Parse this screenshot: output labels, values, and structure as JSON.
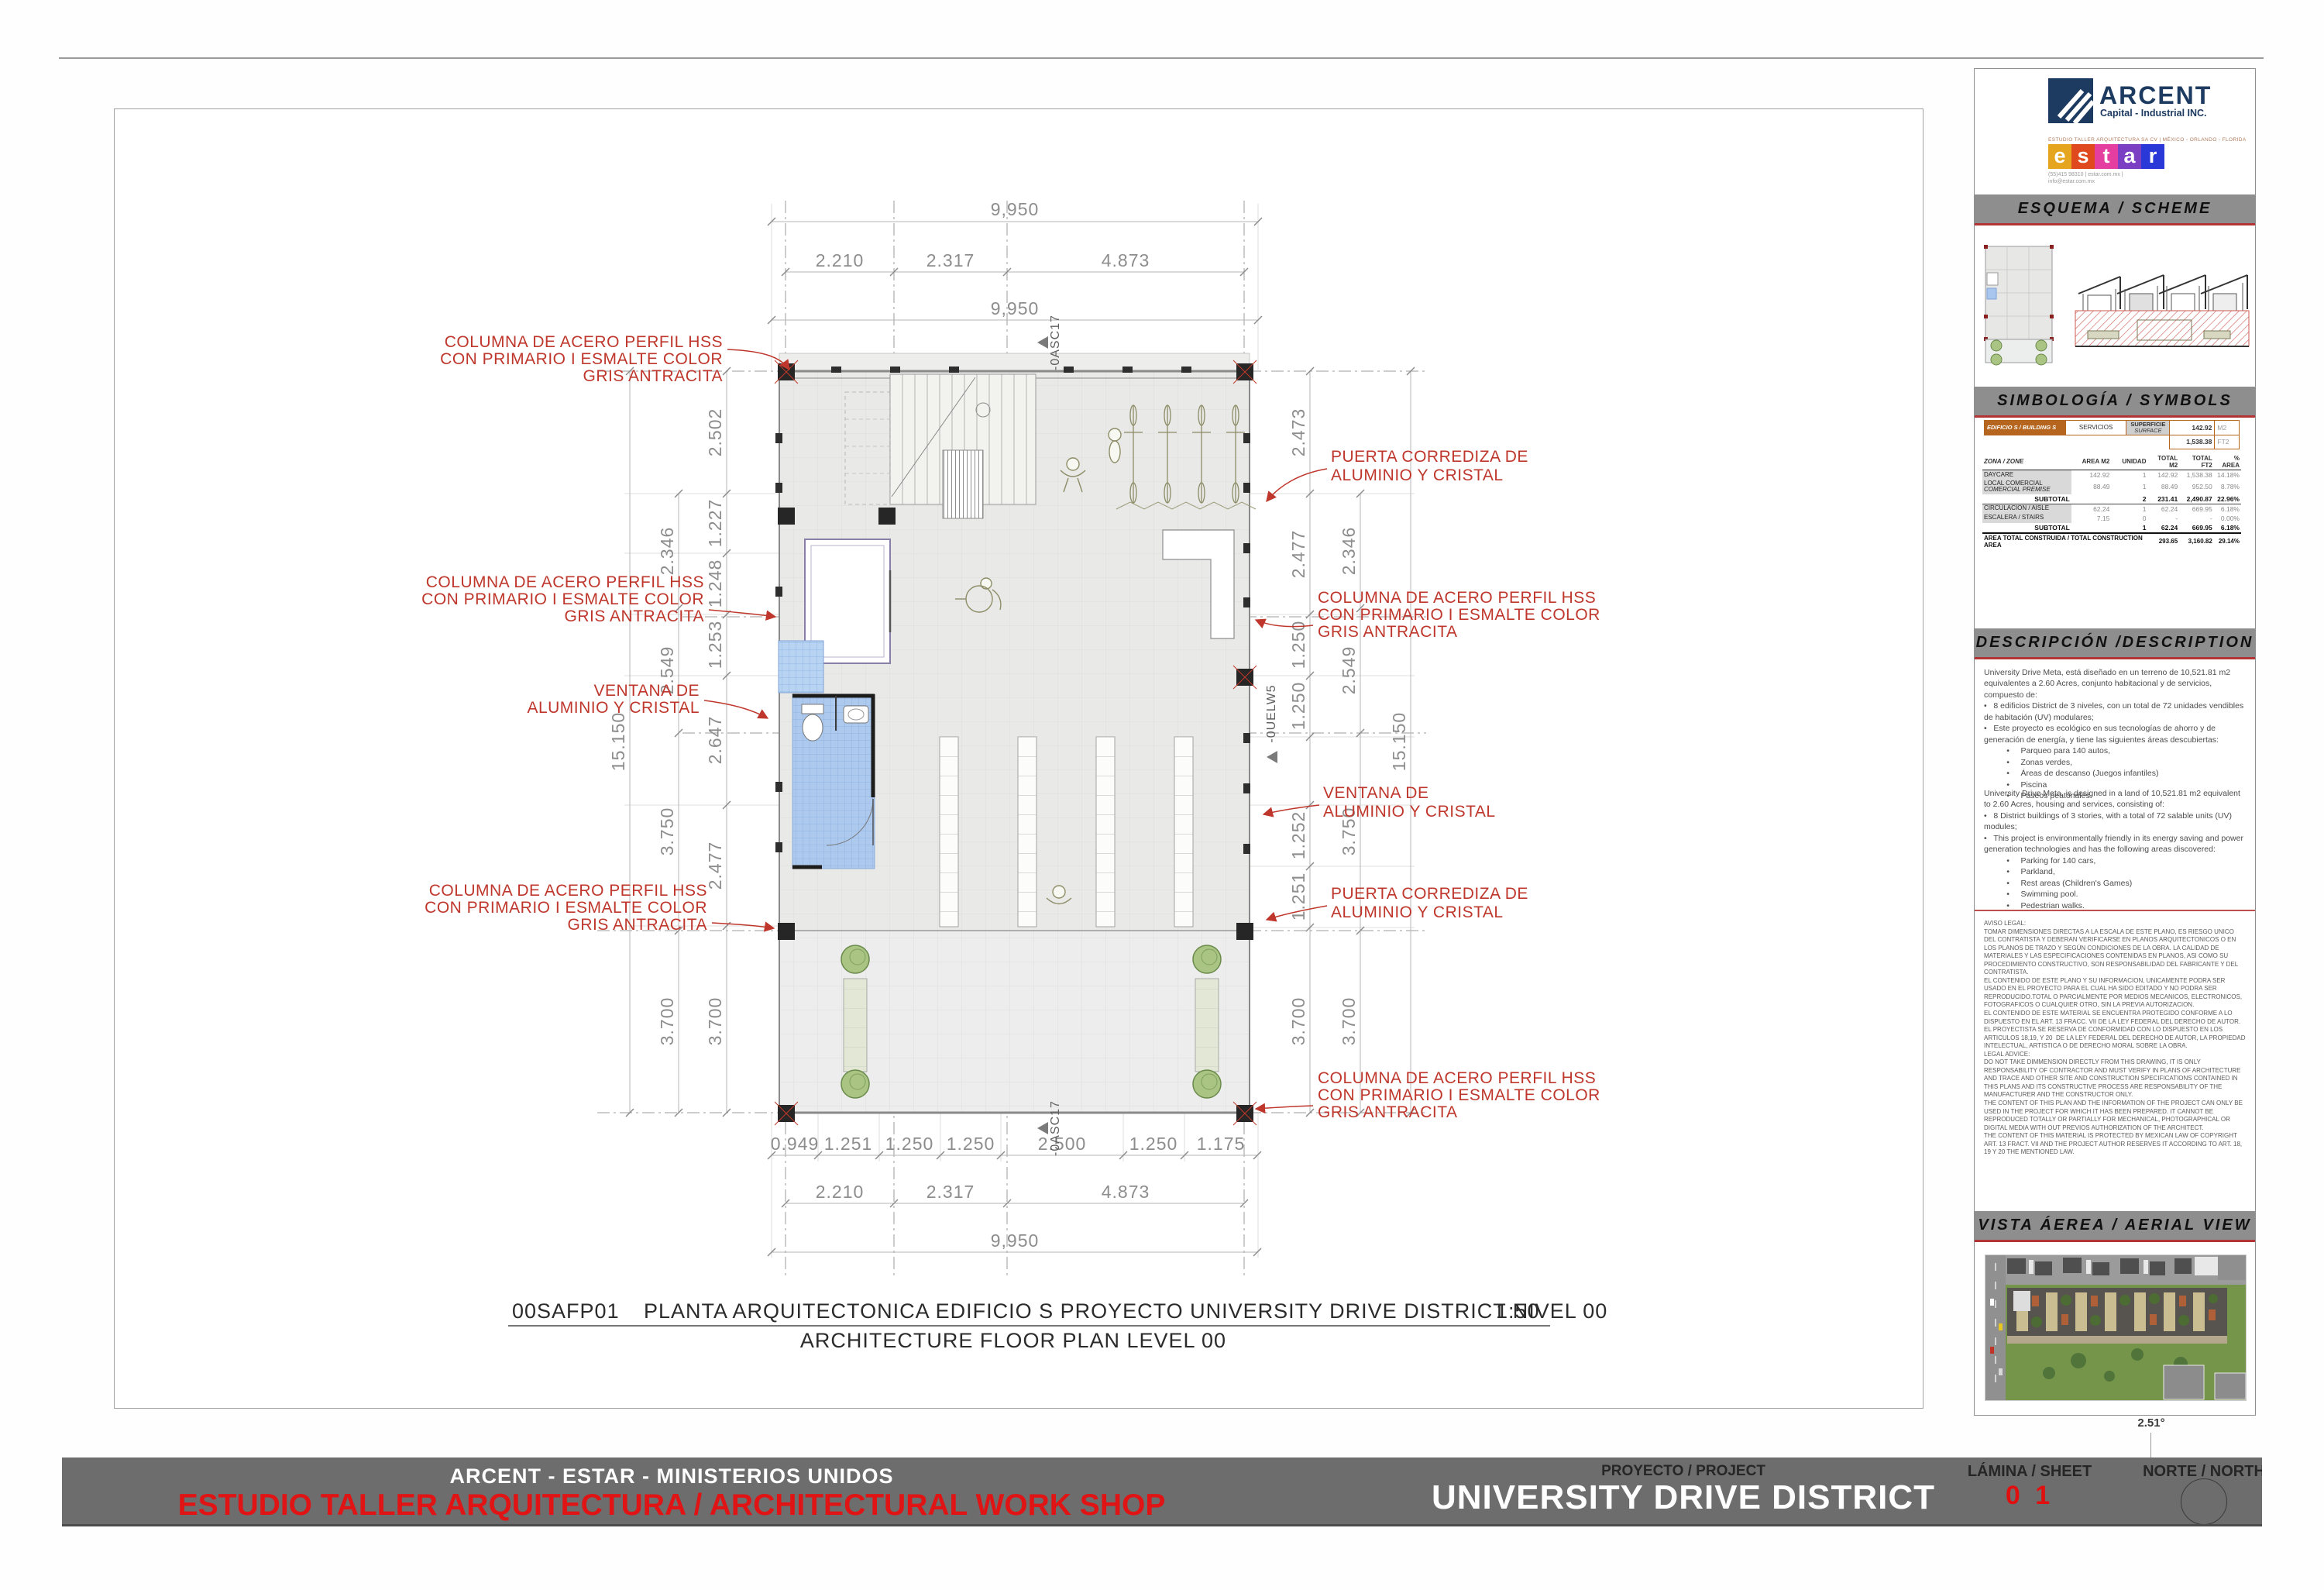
{
  "plan": {
    "title": {
      "code": "00SAFP01",
      "text": "PLANTA ARQUITECTONICA EDIFICIO S  PROYECTO UNIVERSITY DRIVE DISTRICT NIVEL 00",
      "scale": "1:50",
      "subtitle": "ARCHITECTURE FLOOR PLAN LEVEL 00"
    },
    "dims": {
      "total_w": "9,950",
      "total_h": "15.150",
      "top": [
        "2.210",
        "2.317",
        "4.873"
      ],
      "bottom": [
        "0.949",
        "1.251",
        "1.250",
        "1.250",
        "2.500",
        "1.250",
        "1.175"
      ],
      "left_inner": [
        "2.502",
        "1.227",
        "1.248",
        "1.253",
        "2.647",
        "2.477",
        "3.700"
      ],
      "left_mid": [
        "2.346",
        "2.549",
        "3.750",
        "3.700"
      ],
      "right_inner": [
        "2.473",
        "2.477",
        "1.250",
        "1.250",
        "1.252",
        "1.251",
        "3.700"
      ],
      "right_mid": [
        "2.346",
        "2.549",
        "3.750",
        "3.700"
      ]
    },
    "markers": {
      "top": "-0ASC17",
      "bottom": "-0ASC17",
      "right": "-0UELW5"
    },
    "annotations": {
      "columna": [
        "COLUMNA DE ACERO PERFIL HSS",
        "CON PRIMARIO I ESMALTE COLOR",
        "GRIS ANTRACITA"
      ],
      "ventana": [
        "VENTANA DE",
        "ALUMINIO Y CRISTAL"
      ],
      "puerta": [
        "PUERTA CORREDIZA DE",
        "ALUMINIO Y CRISTAL"
      ]
    }
  },
  "panel": {
    "arcent": {
      "name": "ARCENT",
      "tagline": "Capital - Industrial INC."
    },
    "estar": {
      "top": "ESTUDIO TALLER ARQUITECTURA SA CV | MÉXICO - ORLANDO - FLORIDA",
      "letters": [
        "e",
        "s",
        "t",
        "a",
        "r"
      ],
      "colors": [
        "#e6a51e",
        "#e0491d",
        "#e43fa0",
        "#7b3fc4",
        "#2b38d8"
      ],
      "contact": "(55)415 98310   |   estar.com.mx   |\ninfo@estar.com.mx"
    },
    "sections": {
      "esquema": "ESQUEMA / SCHEME",
      "simbologia": "SIMBOLOGÍA / SYMBOLS",
      "descripcion": "DESCRIPCIÓN /DESCRIPTION",
      "vista": "VISTA ÁEREA / AERIAL VIEW"
    },
    "table": {
      "building_label": "EDIFICIO S / BUILDING S",
      "building_use": "SERVICIOS",
      "surface_label_es": "SUPERFICIE",
      "surface_label_en": "SURFACE",
      "surface_m2": "142.92",
      "unit_m2": "M2",
      "surface_ft2": "1,538.38",
      "unit_ft2": "FT2",
      "headers": {
        "zone": "ZONA / ZONE",
        "area": "AREA M2",
        "unit": "UNIDAD",
        "tm2": "TOTAL M2",
        "tft2": "TOTAL FT2",
        "pct": "% AREA"
      },
      "rows": [
        {
          "zone": "DAYCARE",
          "zone2": "",
          "area": "142.92",
          "unit": "1",
          "m2": "142.92",
          "ft2": "1,538.38",
          "pct": "14.18%"
        },
        {
          "zone": "LOCAL COMERCIAL",
          "zone2": "COMERCIAL PREMISE",
          "area": "88.49",
          "unit": "1",
          "m2": "88.49",
          "ft2": "952.50",
          "pct": "8.78%"
        },
        {
          "zone": "SUBTOTAL",
          "zone2": "",
          "area": "",
          "unit": "2",
          "m2": "231.41",
          "ft2": "2,490.87",
          "pct": "22.96%"
        },
        {
          "zone": "CIRCULACION  / AISLE",
          "zone2": "",
          "area": "62.24",
          "unit": "1",
          "m2": "62.24",
          "ft2": "669.95",
          "pct": "6.18%"
        },
        {
          "zone": "ESCALERA / STAIRS",
          "zone2": "",
          "area": "7.15",
          "unit": "0",
          "m2": "-",
          "ft2": "-",
          "pct": "0.00%"
        },
        {
          "zone": "SUBTOTAL",
          "zone2": "",
          "area": "",
          "unit": "1",
          "m2": "62.24",
          "ft2": "669.95",
          "pct": "6.18%"
        }
      ],
      "total": {
        "label": "AREA TOTAL CONSTRUIDA  / TOTAL CONSTRUCTION AREA",
        "m2": "293.65",
        "ft2": "3,160.82",
        "pct": "29.14%"
      }
    },
    "description": {
      "es": "University Drive Meta, está diseñado en un terreno de 10,521.81 m2 equivalentes a 2.60 Acres, conjunto habitacional y de servicios, compuesto de:\n•   8 edificios District de 3 niveles, con un total de 72 unidades vendibles de habitación (UV) modulares;\n•   Este proyecto es ecológico en sus tecnologías de ahorro y de generación de energía, y tiene las siguientes áreas descubiertas:\n          •     Parqueo para 140 autos,\n          •     Zonas verdes,\n          •     Áreas de descanso (Juegos infantiles)\n          •     Piscina\n          •     Paseos peatonales.",
      "en": "University Drive Meta, is designed in a land of 10,521.81 m2 equivalent to 2.60 Acres, housing and services, consisting of:\n•   8 District buildings of 3 stories, with a total of 72 salable units (UV) modules;\n•   This project is environmentally friendly in its energy saving and power generation technologies and has the following areas discovered:\n          •     Parking for 140 cars,\n          •     Parkland,\n          •     Rest areas (Children's Games)\n          •     Swimming pool.\n          •     Pedestrian walks."
    },
    "legal": "AVISO LEGAL:\nTOMAR DIMENSIONES DIRECTAS A LA ESCALA DE ESTE PLANO, ES RIESGO UNICO DEL CONTRATISTA Y DEBERAN VERIFICARSE EN PLANOS ARQUITECTONICOS O EN LOS PLANOS DE TRAZO Y SEGÚN CONDICIONES DE LA OBRA. LA CALIDAD DE MATERIALES Y LAS ESPECIFICACIONES CONTENIDAS EN PLANOS, ASI COMO SU PROCEDIMIENTO CONSTRUCTIVO, SON RESPONSABILIDAD DEL FABRICANTE Y DEL CONTRATISTA.\nEL CONTENIDO DE ESTE PLANO Y SU INFORMACION, UNICAMENTE PODRA SER USADO EN EL PROYECTO PARA EL CUAL HA SIDO EDITADO Y NO PODRA SER REPRODUCIDO.TOTAL O PARCIALMENTE POR MEDIOS MECANICOS, ELECTRONICOS, FOTOGRAFICOS O CUALQUIER OTRO, SIN LA PREVIA AUTORIZACION.\nEL CONTENIDO DE ESTE MATERIAL SE ENCUENTRA PROTEGIDO CONFORME A LO DISPUESTO EN EL ART. 13 FRACC. VII DE LA LEY FEDERAL DEL DERECHO DE AUTOR. EL PROYECTISTA SE RESERVA DE CONFORMIDAD CON LO DISPUESTO EN LOS ARTICULOS 18,19, Y 20  DE LA LEY FEDERAL DEL DERECHO DE AUTOR, LA PROPIEDAD INTELECTUAL, ARTISTICA O DE DERECHO MORAL SOBRE LA OBRA.\nLEGAL ADVICE:\nDO NOT TAKE DIMMENSION DIRECTLY FROM THIS DRAWING, IT IS ONLY RESPONSABILITY OF CONTRACTOR AND MUST VERIFY IN PLANS OF ARCHITECTURE\nAND TRACE AND OTHER SITE AND CONSTRUCTION SPECIFICATIONS CONTAINED IN THIS PLANS AND ITS CONSTRUCTIVE PROCESS ARE RESPONSABILITY OF THE MANUFACTURER AND THE CONSTRUCTOR ONLY.\nTHE CONTENT OF THIS PLAN AND THE INFORMATION OF THE PROJECT CAN ONLY BE USED IN THE PROJECT FOR WHICH IT HAS BEEN PREPARED. IT CANNOT BE REPRODUCED TOTALLY OR PARTIALLY FOR MECHANICAL, PHOTOGRAPHICAL OR DIGITAL MEDIA WITH OUT PREVIOS AUTHORIZATION OF THE ARCHITECT.\nTHE CONTENT OF THIS MATERIAL IS PROTECTED BY MEXICAN LAW OF COPYRIGHT ART. 13 FRACT. VII AND THE PROJECT AUTHOR RESERVES IT ACCORDING TO ART. 18, 19 Y 20 THE MENTIONED LAW.",
    "aerial_angle": "2.51°"
  },
  "footer": {
    "company_line": "ARCENT - ESTAR - MINISTERIOS UNIDOS",
    "studio_line": "ESTUDIO TALLER ARQUITECTURA  / ARCHITECTURAL WORK SHOP",
    "project_label": "PROYECTO / PROJECT",
    "project_name": "UNIVERSITY DRIVE DISTRICT",
    "sheet_label": "LÁMINA / SHEET",
    "sheet_number": "0 1",
    "north_label": "NORTE / NORTH"
  }
}
